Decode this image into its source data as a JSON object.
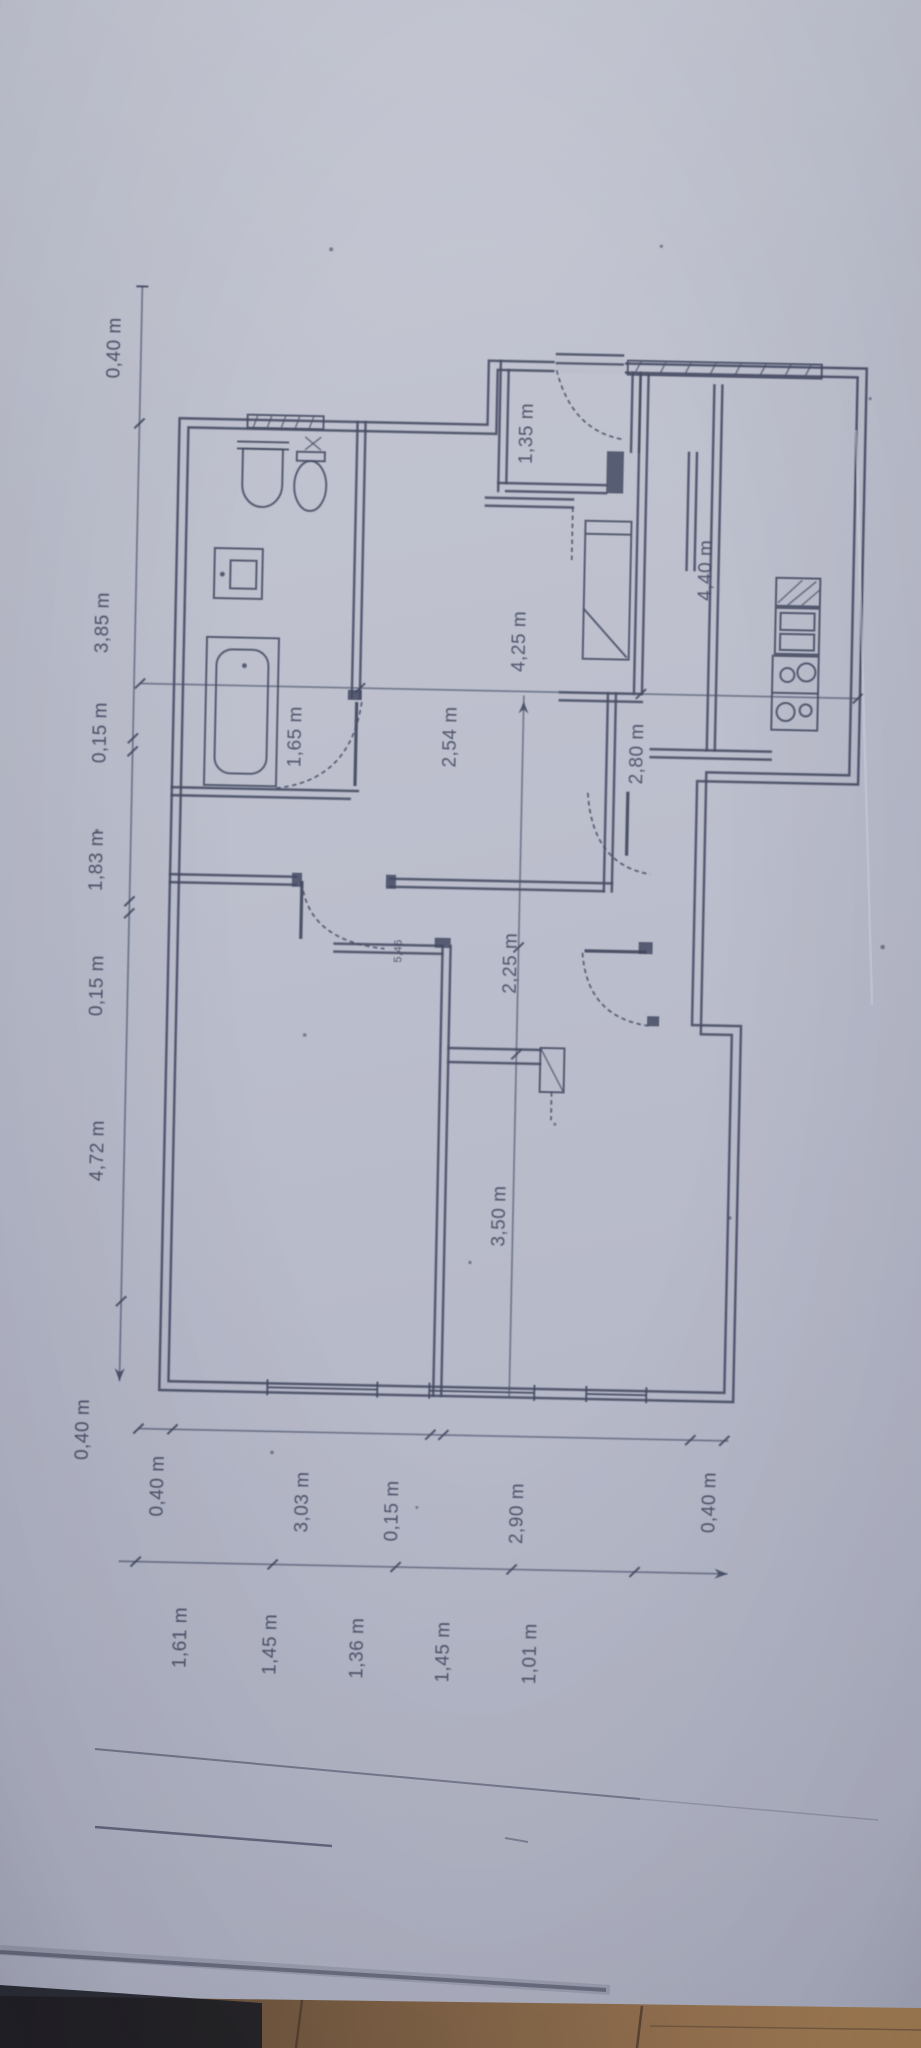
{
  "photo": {
    "paper_color": "#b9bcca",
    "ink_color": "#3a4058",
    "wood_color": "#7b5c3e",
    "description": "Scanned floor plan sheet photographed on a wooden floor, drawing rotated 90 degrees"
  },
  "floor_plan": {
    "left_chain": {
      "labels": [
        "0,40 m",
        "3,85 m",
        "0,15 m",
        "1,83 m",
        "0,15 m",
        "4,72 m",
        "0,40 m"
      ]
    },
    "bottom_outer_chain": {
      "labels": [
        "0,40 m",
        "3,03 m",
        "0,15 m",
        "2,90 m",
        "0,40 m"
      ]
    },
    "bottom_inner_chain": {
      "labels": [
        "1,61 m",
        "1,45 m",
        "1,36 m",
        "1,45 m",
        "1,01 m"
      ]
    },
    "room_labels": {
      "entry": "1,35 m",
      "kitchen_depth": "4,40 m",
      "hall_depth": "4,25 m",
      "hall_width": "2,54 m",
      "bathroom_width": "1,65 m",
      "kitchen_width": "2,80 m",
      "corridor_width": "2,25 m",
      "room_width": "3,50 m",
      "door_note": "5,46"
    }
  }
}
